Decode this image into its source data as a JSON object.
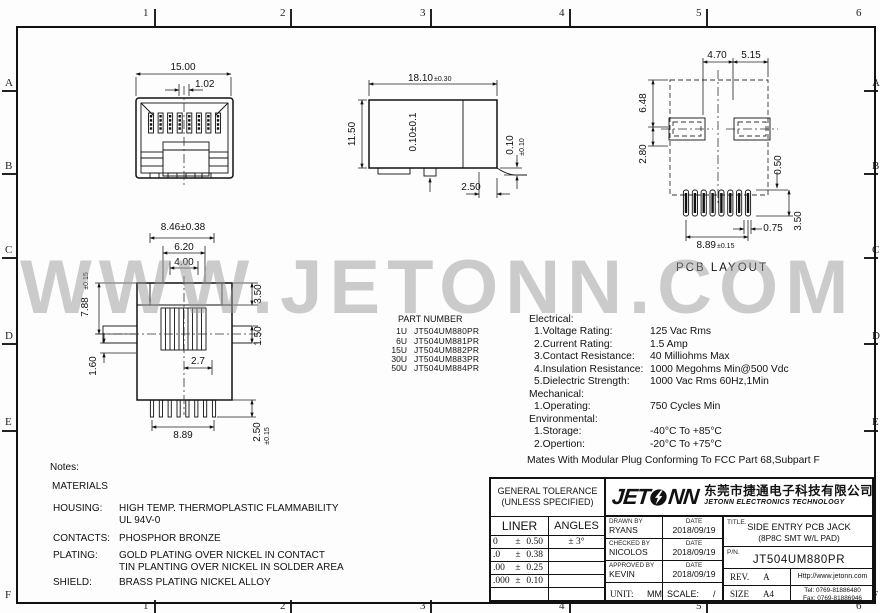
{
  "sheet": {
    "zones_top": [
      "1",
      "2",
      "3",
      "4",
      "5",
      "6"
    ],
    "zones_bottom": [
      "1",
      "2",
      "3",
      "4",
      "5",
      "6"
    ],
    "zones_left": [
      "A",
      "B",
      "C",
      "D",
      "E",
      "F"
    ],
    "zones_right": [
      "A",
      "B",
      "C",
      "D",
      "E",
      "F"
    ],
    "watermark": "WWW.JETONN.COM"
  },
  "views": {
    "front": {
      "dim_width": "15.00",
      "dim_slot": "1.02",
      "dim_span": "8.46±0.38"
    },
    "side": {
      "dim_width": "18.10",
      "dim_width_tol": "±0.30",
      "dim_height": "11.50",
      "dim_inner": "0.10±0.1",
      "dim_foot": "0.10",
      "dim_foot_tol": "±0.10",
      "dim_offset": "2.50"
    },
    "pcb": {
      "caption": "PCB LAYOUT",
      "dim_a": "4.70",
      "dim_b": "5.15",
      "dim_c": "6.48",
      "dim_d": "2.80",
      "dim_e": "0.50",
      "dim_f": "0.75",
      "dim_g": "3.50",
      "dim_span": "8.89",
      "dim_span_tol": "±0.15"
    },
    "bottom": {
      "dim_span": "6.20",
      "dim_inner": "4.00",
      "dim_height": "7.88",
      "dim_height_tol": "±0.15",
      "dim_top": "3.50",
      "dim_mid": "1.50",
      "dim_low": "1.60",
      "dim_offset": "2.7",
      "dim_pins": "8.89",
      "dim_pin_len": "2.50",
      "dim_pin_len_tol": "±0.15"
    }
  },
  "part_table": {
    "title": "PART NUMBER",
    "rows": [
      {
        "qty": "1U",
        "pn": "JT504UM880PR"
      },
      {
        "qty": "6U",
        "pn": "JT504UM881PR"
      },
      {
        "qty": "15U",
        "pn": "JT504UM882PR"
      },
      {
        "qty": "30U",
        "pn": "JT504UM883PR"
      },
      {
        "qty": "50U",
        "pn": "JT504UM884PR"
      }
    ]
  },
  "specs": {
    "electrical_heading": "Electrical:",
    "electrical": [
      {
        "label": "1.Voltage Rating:",
        "value": "125 Vac Rms"
      },
      {
        "label": "2.Current Rating:",
        "value": "1.5 Amp"
      },
      {
        "label": "3.Contact Resistance:",
        "value": "40 Milliohms Max"
      },
      {
        "label": "4.Insulation Resistance:",
        "value": "1000 Megohms Min@500 Vdc"
      },
      {
        "label": "5.Dielectric Strength:",
        "value": "1000 Vac Rms 60Hz,1Min"
      }
    ],
    "mechanical_heading": "Mechanical:",
    "mechanical": [
      {
        "label": "1.Operating:",
        "value": "750 Cycles Min"
      }
    ],
    "environmental_heading": "Environmental:",
    "environmental": [
      {
        "label": "1.Storage:",
        "value": "-40°C To +85°C"
      },
      {
        "label": "2.Opertion:",
        "value": "-20°C To +75°C"
      }
    ],
    "footer": "Mates With Modular Plug Conforming To FCC Part 68,Subpart F"
  },
  "notes": {
    "heading": "Notes:",
    "materials_heading": "MATERIALS",
    "rows": [
      {
        "label": "HOUSING:",
        "line1": "HIGH TEMP. THERMOPLASTIC FLAMMABILITY",
        "line2": "UL 94V-0"
      },
      {
        "label": "CONTACTS:",
        "line1": "PHOSPHOR BRONZE",
        "line2": ""
      },
      {
        "label": "PLATING:",
        "line1": "GOLD PLATING OVER NICKEL IN CONTACT",
        "line2": "TIN PLANTING OVER NICKEL IN SOLDER AREA"
      },
      {
        "label": "SHIELD:",
        "line1": "BRASS PLATING NICKEL ALLOY",
        "line2": ""
      }
    ]
  },
  "title_block": {
    "tolerance": {
      "heading1": "GENERAL TOLERANCE",
      "heading2": "(UNLESS SPECIFIED)",
      "liner_label": "LINER",
      "angles_label": "ANGLES",
      "rows": [
        {
          "base": "0",
          "pm": "±",
          "tol": "0.50",
          "angle": "± 3°"
        },
        {
          "base": ".0",
          "pm": "±",
          "tol": "0.38",
          "angle": ""
        },
        {
          "base": ".00",
          "pm": "±",
          "tol": "0.25",
          "angle": ""
        },
        {
          "base": ".000",
          "pm": "±",
          "tol": "0.10",
          "angle": ""
        }
      ]
    },
    "company": {
      "logo_text_left": "JET",
      "logo_text_right": "NN",
      "cn_name": "东莞市捷通电子科技有限公司",
      "en_name": "JETONN ELECTRONICS TECHNOLOGY"
    },
    "signoff": [
      {
        "role": "DRAWN BY",
        "name": "RYANS",
        "date_label": "DATE",
        "date": "2018/09/19"
      },
      {
        "role": "CHECKED BY",
        "name": "NICOLOS",
        "date_label": "DATE",
        "date": "2018/09/19"
      },
      {
        "role": "APPROVED BY",
        "name": "KEVIN",
        "date_label": "DATE",
        "date": "2018/09/19"
      }
    ],
    "unit_label": "UNIT:",
    "unit_value": "MM",
    "scale_label": "SCALE:",
    "scale_value": "/",
    "title_label": "TITLE.",
    "title_line1": "SIDE ENTRY PCB JACK",
    "title_line2": "(8P8C SMT W/L PAD)",
    "pn_label": "P/N.",
    "pn_value": "JT504UM880PR",
    "rev_label": "REV.",
    "rev_value": "A",
    "size_label": "SIZE",
    "size_value": "A4",
    "website": "Http://www.jetonn.com",
    "tel": "Tel:  0769-81886480",
    "fax": "Fax: 0769-81886946"
  }
}
